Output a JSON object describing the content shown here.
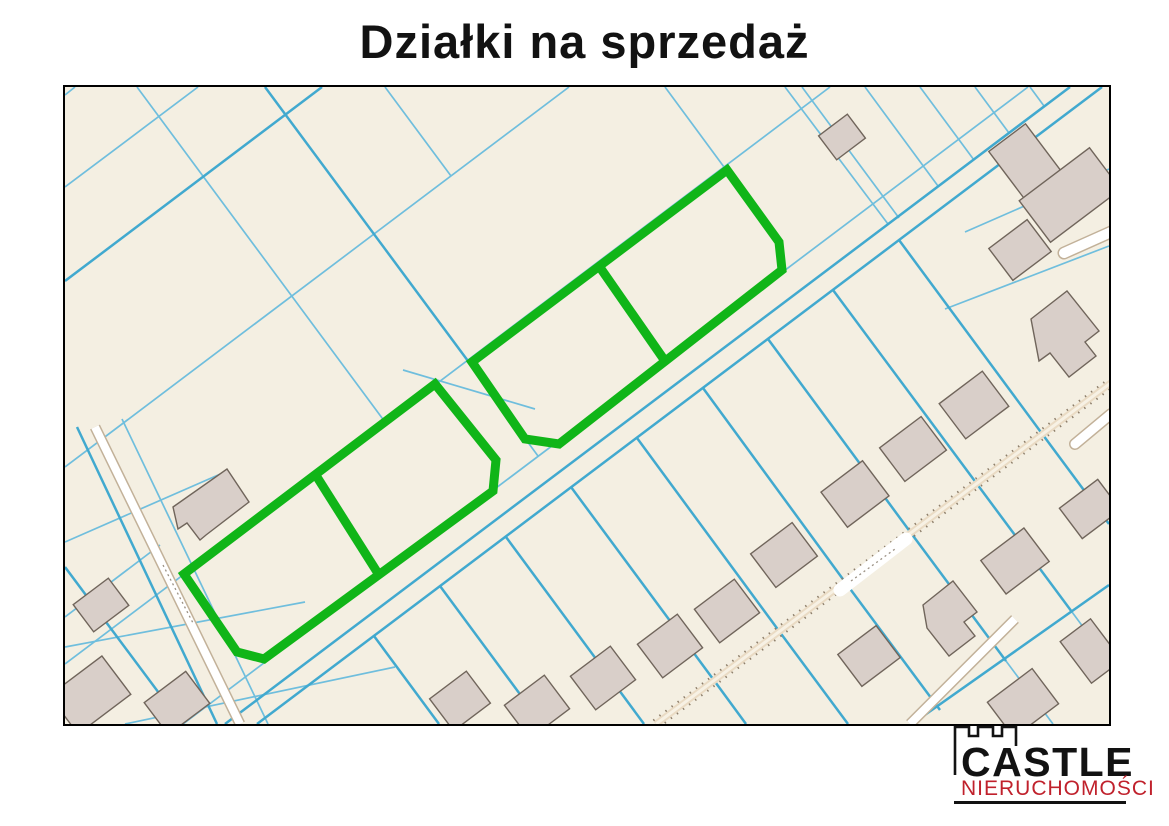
{
  "title": "Działki na sprzedaż",
  "logo": {
    "name": "CASTLE",
    "subtitle": "NIERUCHOMOŚCI"
  },
  "map": {
    "kind": "cadastral parcel map",
    "highlighted_plots_count": 4,
    "highlighted_plot_groups": 2
  },
  "colors": {
    "page_bg": "#ffffff",
    "ink": "#121212",
    "map_bg": "#f4efe2",
    "map_border": "#000000",
    "parcel_blue": "#6fbedd",
    "parcel_blue_strong": "#41a9cf",
    "plot_green": "#10b518",
    "building_fill": "#d9cfc9",
    "building_stroke": "#70655b",
    "road_edge": "#c2b199",
    "road_tick": "#8d7e6a",
    "road_surface": "#eadbc4",
    "logo_red": "#c0212c"
  }
}
